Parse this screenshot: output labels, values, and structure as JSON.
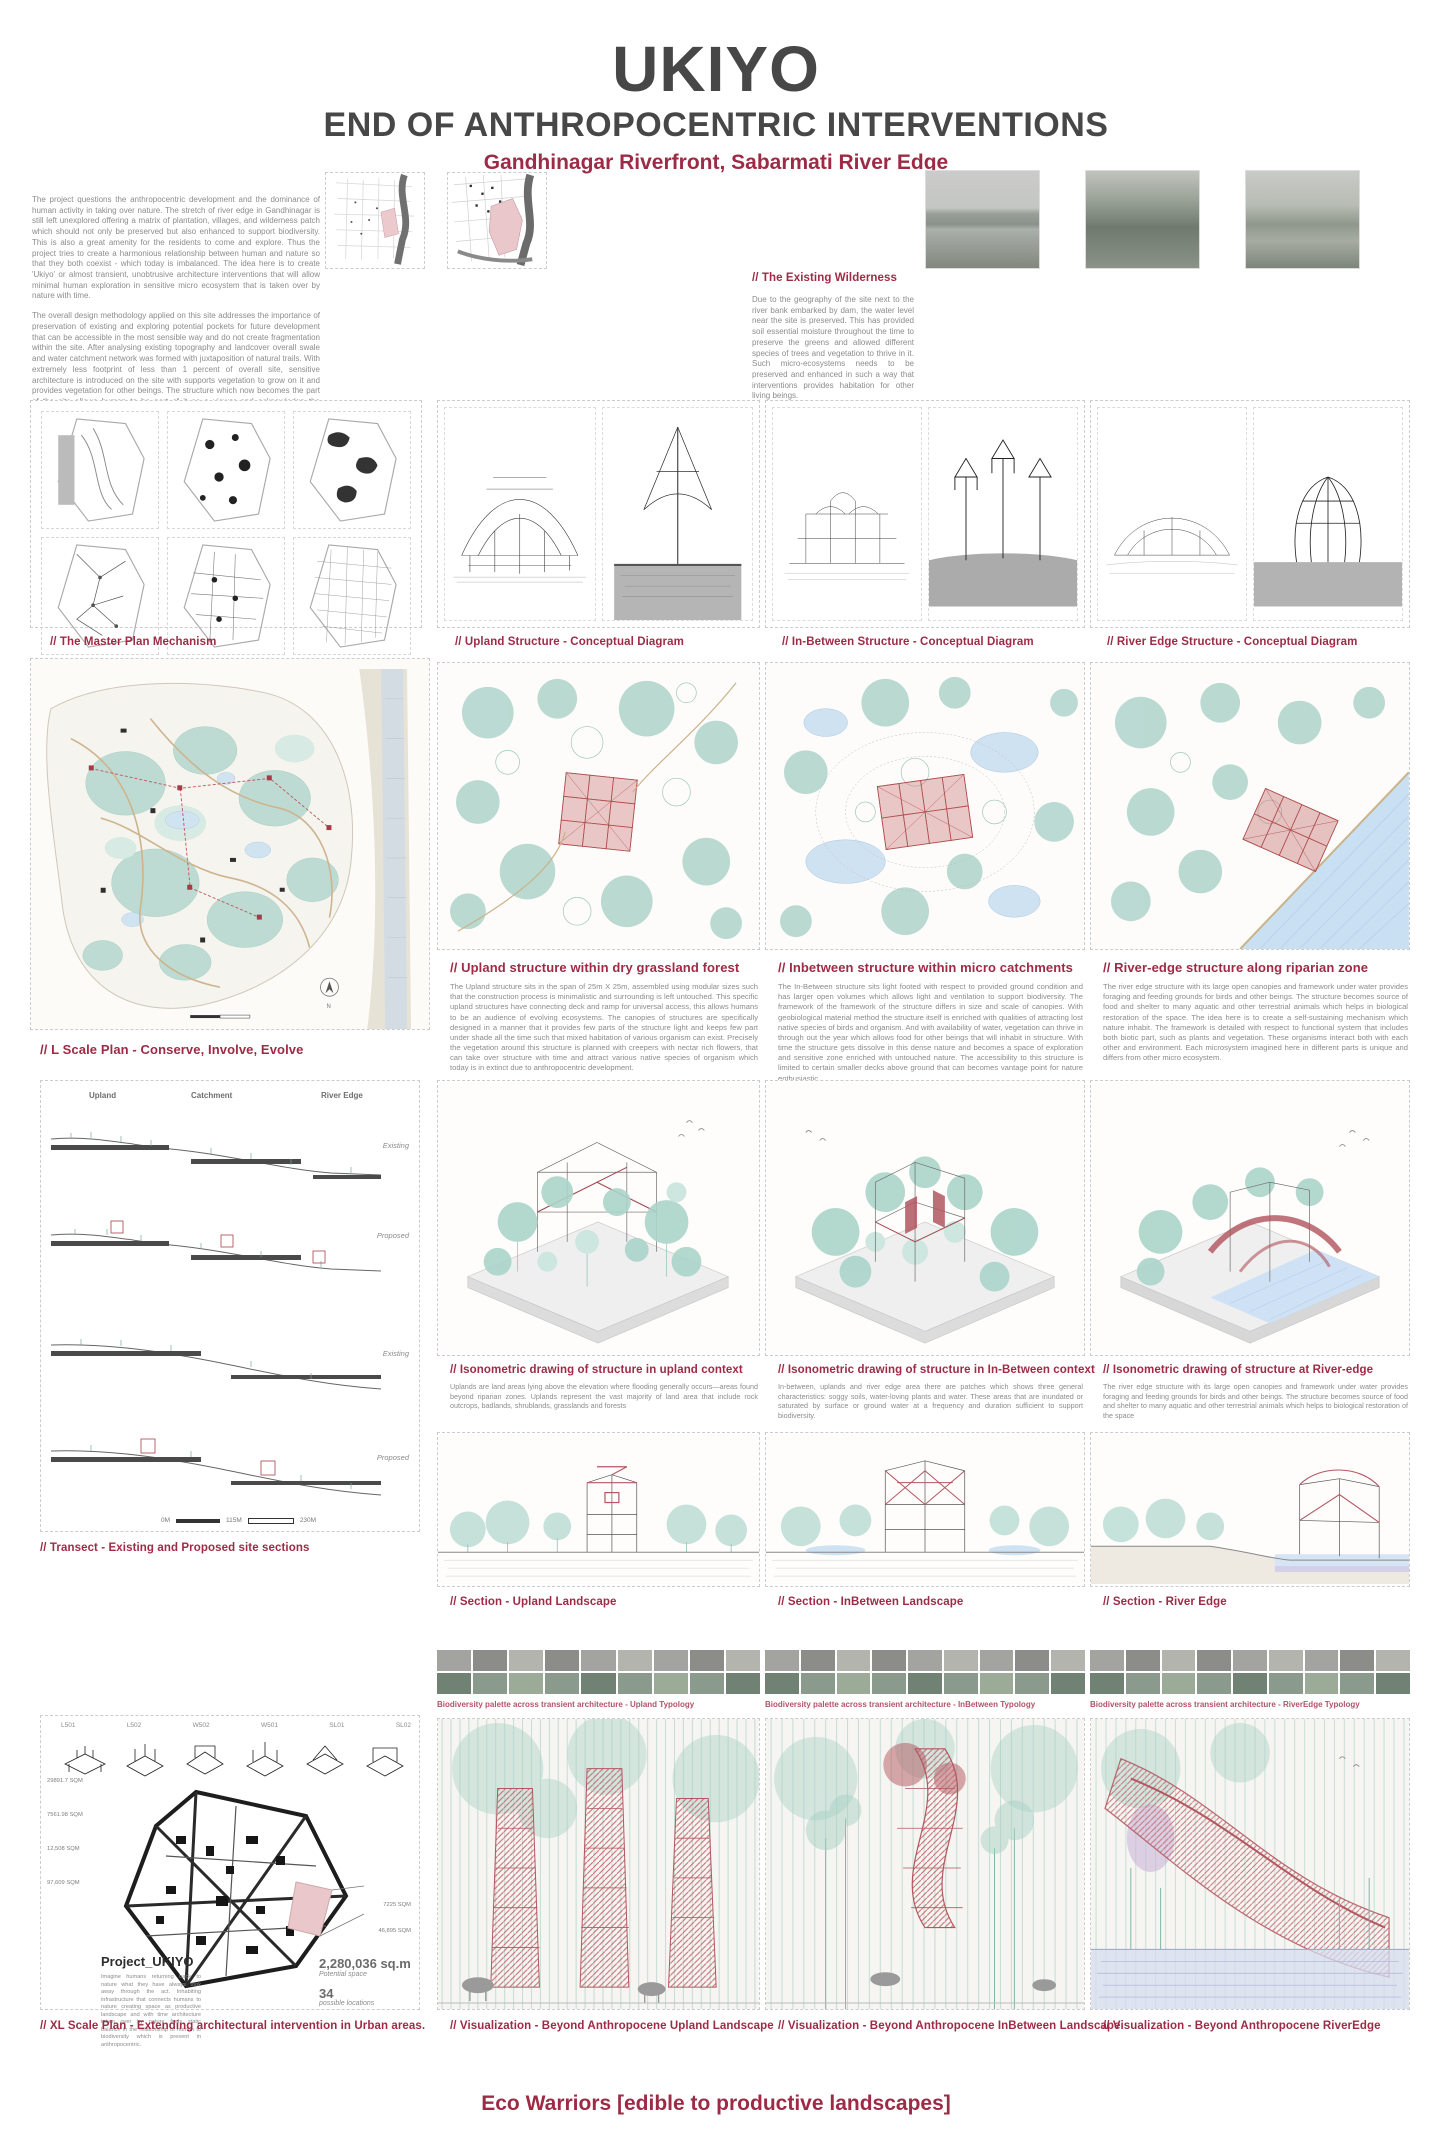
{
  "header": {
    "title": "UKIYO",
    "subtitle": "END OF ANTHROPOCENTRIC INTERVENTIONS",
    "location": "Gandhinagar Riverfront, Sabarmati River Edge"
  },
  "intro": {
    "para1": "The project questions the anthropocentric development and the dominance of human activity in taking over nature. The stretch of river edge in Gandhinagar is still left unexplored offering a matrix of plantation, villages, and wilderness patch which should not only be preserved but also enhanced to support biodiversity. This is also a great amenity for the residents to come and explore. Thus the project tries to create a harmonious relationship between human and nature so that they both coexist - which today is imbalanced. The idea here is to create 'Ukiyo' or almost transient, unobtrusive architecture interventions that will allow minimal human exploration in sensitive micro ecosystem that is taken over by nature with time.",
    "para2": "The overall design methodology applied on this site addresses the importance of preservation of existing and exploring potential pockets for future development that can be accessible in the most sensible way and do not create fragmentation within the site. After analysing existing topography and landcover overall swale and water catchment network was formed with juxtaposition of natural trails. With extremely less footprint of less than 1 percent of overall site, sensitive architecture is introduced on the site with supports vegetation to grow on it and provides vegetation for other beings. The structure which now becomes the part of the site allows human to be part of it as a viewer and acknowledge the mysteries of nature around. The light infrastructure is taken over by nature with time due to its intrigue details which allows life to grow on it and with time becomes a ruin for humans and house for other beings."
  },
  "wilderness": {
    "title": "// The Existing Wilderness",
    "body": "Due to the geography of the site next to the river bank embarked by dam, the water level near the site is preserved. This has provided soil essential moisture throughout the time to preserve the greens and allowed different species of trees and vegetation to thrive in it. Such micro-ecosystems needs to be preserved and enhanced in such a way that interventions provides habitation for other living beings."
  },
  "concepts": {
    "captions": [
      "// The Master Plan Mechanism",
      "// Upland Structure - Conceptual Diagram",
      "// In-Between Structure - Conceptual Diagram",
      "// River Edge Structure - Conceptual Diagram"
    ]
  },
  "master_plan": {
    "caption": "// L Scale Plan  - Conserve, Involve, Evolve"
  },
  "structures": [
    {
      "caption": "// Upland structure within dry grassland forest",
      "body": "The Upland structure sits in the span of 25m X 25m, assembled using modular sizes such that the construction process is minimalistic and surrounding is left untouched. This specific upland structures have connecting deck and ramp for universal access, this allows humans to be an audience of evolving ecosystems. The canopies of structures are specifically designed in a manner that it provides few parts of the structure light and keeps few part under shade all the time such that mixed habitation of various organism can exist. Precisely the vegetation around this structure is planned with creepers with nectar rich flowers, that can take over structure with time and attract various native species of organism which today is in extinct due to anthropocentric development."
    },
    {
      "caption": "// Inbetween structure within micro catchments",
      "body": "The In-Between structure sits light footed with respect to provided ground condition and has larger open volumes which allows light and ventilation to support biodiversity. The framework of the framework of the structure differs in size and scale of canopies. With geobiological material method the structure itself is enriched with qualities of attracting lost native species of birds and organism. And with availability of water, vegetation can thrive in through out the year which allows food for other beings that will inhabit in structure. With time the structure gets dissolve in this dense nature and becomes a space of exploration and sensitive zone enriched with untouched nature. The accessibility to this structure is limited to certain smaller decks above ground that can becomes vantage point for nature enthusiastic."
    },
    {
      "caption": "// River-edge structure along riparian zone",
      "body": "The river edge structure with its large open canopies and framework under water provides foraging and feeding grounds for birds and other beings. The structure becomes source of food and shelter to many aquatic and other terrestrial animals which helps in biological restoration of the space. The idea here is to create a self-sustaining mechanism which nature inhabit. The framework is detailed with respect to functional system that includes both biotic part, such as plants and vegetation. These organisms interact both with each other and environment. Each microsystem imagined here in different parts is unique and differs from other micro ecosystem."
    }
  ],
  "transect": {
    "caption": "// Transect - Existing and Proposed site sections",
    "zones": [
      "Upland",
      "Catchment",
      "River Edge"
    ],
    "states": [
      "Existing",
      "Proposed",
      "Existing",
      "Proposed"
    ],
    "scale": [
      "0M",
      "115M",
      "230M"
    ]
  },
  "isometrics": [
    {
      "caption": "// Isonometric drawing of structure in upland context",
      "body": "Uplands are land areas lying above the elevation where flooding generally occurs—areas found beyond riparian zones. Uplands represent the vast majority of land area that include rock outcrops, badlands, shrublands, grasslands and forests"
    },
    {
      "caption": "// Isonometric drawing of structure in In-Between context",
      "body": "In-between, uplands and river edge area there are patches which shows three general characteristics: soggy soils, water-loving plants and water. These areas that are inundated or saturated by surface or ground water at a frequency and duration sufficient to support biodiversity."
    },
    {
      "caption": "// Isonometric drawing of structure at River-edge",
      "body": "The river edge structure with its large open canopies and framework under water provides foraging and feeding grounds for birds and other beings. The structure becomes source of food and shelter to many aquatic and other terrestrial animals which helps to biological restoration of the space"
    }
  ],
  "sections": {
    "captions": [
      "// Section - Upland Landscape",
      "// Section - InBetween Landscape",
      "// Section - River Edge"
    ]
  },
  "biodiversity": {
    "captions": [
      "Biodiversity palette across transient architecture - Upland Typology",
      "Biodiversity palette across transient architecture - InBetween Typology",
      "Biodiversity palette across transient architecture - RiverEdge Typology"
    ]
  },
  "xl_plan": {
    "codes": [
      "L501",
      "L502",
      "W502",
      "W501",
      "SL01",
      "SL02"
    ],
    "area_labels_left": [
      "29891.7 SQM",
      "7561.98 SQM",
      "12,508 SQM",
      "97,609 SQM"
    ],
    "area_labels_right": [
      "7225 SQM",
      "46,895 SQM"
    ],
    "project_title": "Project_UKIYO",
    "project_body": "Imagine humans returning back to nature what they have always took away through the act. Inhabiting infrastructure that connects humans to nature creating space as productive landscape and with time architecture taken over by nature finds static balance in the relationship of human to biodiversity which is present in anthropocentric.",
    "stat1_value": "2,280,036 sq.m",
    "stat1_label": "Potential space",
    "stat2_value": "34",
    "stat2_label": "possible locations",
    "caption": "// XL Scale Plan - Extending architectural intervention in Urban areas."
  },
  "visualizations": {
    "captions": [
      "// Visualization - Beyond Anthropocene Upland Landscape",
      "// Visualization - Beyond Anthropocene InBetween Landscape",
      "// Visualization - Beyond Anthropocene RiverEdge"
    ]
  },
  "footer": "Eco Warriors [edible to productive landscapes]",
  "colors": {
    "accent": "#9e2b45",
    "heading": "#474747",
    "body_text": "#8c8c8c",
    "teal": "#a9d2c7",
    "structure_red": "#b25760",
    "water": "#cfe2f2"
  }
}
